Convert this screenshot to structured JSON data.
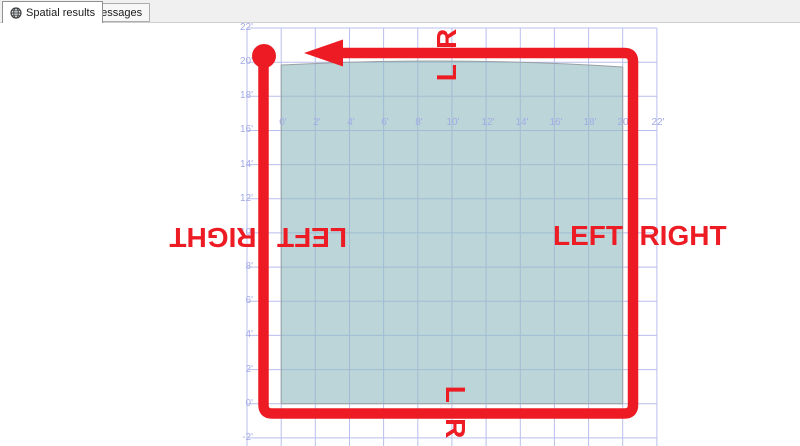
{
  "tabs": {
    "spatial": {
      "label": "Spatial results",
      "icon": "globe-icon"
    },
    "messages": {
      "label": "Messages",
      "icon": "messages-icon"
    }
  },
  "plot": {
    "y_ticks": [
      "22'",
      "20'",
      "18'",
      "16'",
      "14'",
      "12'",
      "10'",
      "8'",
      "6'",
      "4'",
      "2'",
      "0'",
      "-2'"
    ],
    "x_ticks": [
      "0'",
      "2'",
      "4'",
      "6'",
      "8'",
      "10'",
      "12'",
      "14'",
      "16'",
      "18'",
      "20'",
      "22'"
    ],
    "annotations": {
      "top_lr": "L R",
      "bottom_lr": "L R",
      "left_outer": "RIGHT",
      "left_inner": "LEFT",
      "right_inner": "LEFT",
      "right_outer": "RIGHT"
    },
    "colors": {
      "annotation_red": "#ed1c24",
      "grid_line": "#b9bfee",
      "tick_label": "#a3abe6",
      "polygon_fill": "#b5d2d5"
    }
  }
}
